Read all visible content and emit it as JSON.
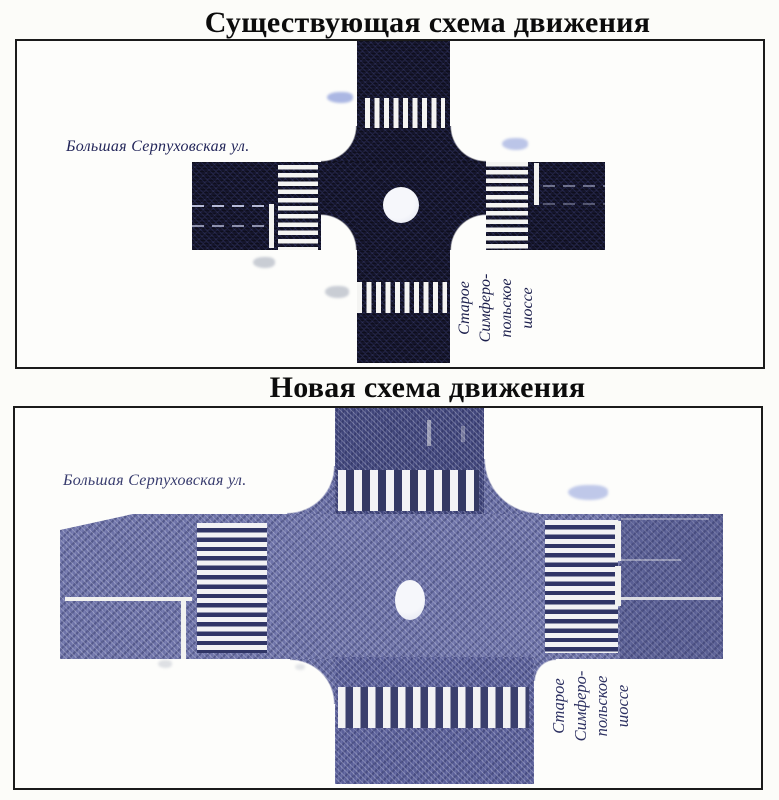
{
  "existing_scheme": {
    "title": "Существующая схема движения",
    "street_label": "Большая Серпуховская ул.",
    "highway_label_lines": [
      "Старое",
      "Симферо-",
      "польское",
      "шоссе"
    ],
    "colors": {
      "road": "#15152b",
      "stripe": "#f4f4f2",
      "island": "#f6f7fb"
    }
  },
  "new_scheme": {
    "title": "Новая схема движения",
    "street_label": "Большая Серпуховская ул.",
    "highway_label_lines": [
      "Старое",
      "Симферо-",
      "польское",
      "шоссе"
    ],
    "colors": {
      "road_band": "#6e73a8",
      "road_top_arm": "#41467b",
      "road_bottom_arm": "#5b6099",
      "stripe": "#f2f2f4",
      "island": "#f6f7fb"
    }
  }
}
